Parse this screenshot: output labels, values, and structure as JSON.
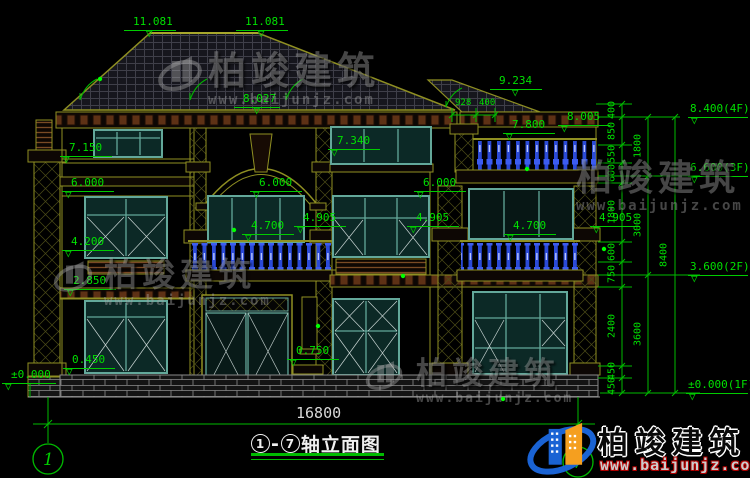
{
  "drawing_title": {
    "axis_start": "1",
    "dash": "-",
    "axis_end": "7",
    "name": "轴立面图"
  },
  "bottom": {
    "overall_dim": "16800",
    "axis_left": "1",
    "axis_right": "7"
  },
  "top_dims": {
    "ridge_left": "11.081",
    "ridge_right": "11.081",
    "secondary_ridge": "9.234",
    "eave_elev": "8.027",
    "eave_overhang": "928",
    "eave_overhang2": "400"
  },
  "left_marks": {
    "eave": "7.150",
    "floor3": "6.000",
    "window2": "4.200",
    "cornice": "2.850",
    "sill1": "0.450",
    "ground": "±0.000"
  },
  "center_marks": {
    "eave": "7.340",
    "arch": "6.000",
    "balcony": "4.700",
    "cap": "4.905",
    "porch": "0.750"
  },
  "right_marks": {
    "floor3": "6.000",
    "cap_left": "4.905",
    "balcony": "4.700",
    "cap_right": "4.905",
    "rail": "7.800",
    "post": "8.005"
  },
  "right_levels": {
    "l4": "8.400(4F)",
    "l3": "6.600(3F)",
    "l2": "3.600(2F)",
    "l1": "±0.000(1F)",
    "chain_inner": [
      "400",
      "850",
      "550",
      "600",
      "1800",
      "600",
      "750",
      "2400",
      "450",
      "450"
    ],
    "chain_mid": [
      "1800",
      "3000",
      "3600"
    ],
    "total": "8400"
  },
  "brand": {
    "name": "柏竣建筑",
    "url": "www.baijunjz.com"
  },
  "colors": {
    "dim_green": "#00e000",
    "line_olive": "#8f8f22",
    "window_teal": "#63a89a",
    "baluster_blue": "#2b4ad8",
    "dentil_brown": "#5e3115",
    "white": "#d9d9d9",
    "brand_blue": "#1a63d4",
    "brand_orange": "#f59f1f",
    "logo_red": "#b00000"
  }
}
